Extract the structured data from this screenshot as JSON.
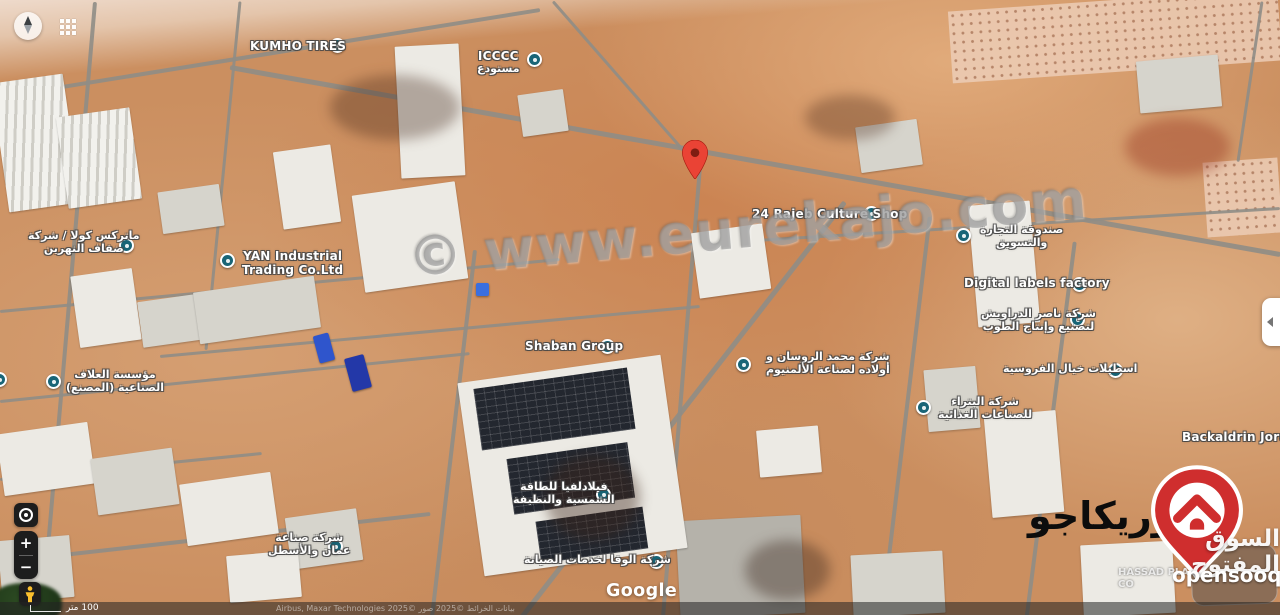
{
  "watermarks": {
    "center_url": "© www.eurekajo.com",
    "eurekajo_arabic": "يوريكاجو",
    "opensooq_arabic": "السوق المفتوح",
    "opensooq_latin": "opensooq"
  },
  "google_logo": "Google",
  "attribution": {
    "scale_label": "100 متر",
    "credits": "بيانات الخرائط ©2025 صور ©2025 Airbus, Maxar Technologies"
  },
  "controls": {
    "zoom_in": "+",
    "zoom_out": "−"
  },
  "hidden_label": {
    "line1": "HASSAD PLA",
    "line2": "CO"
  },
  "pin_color": "#ea4335",
  "marker_color": "#196577",
  "labels": [
    {
      "name": "kumho-tires",
      "lines": [
        "KUMHO TIRES"
      ],
      "x": 250,
      "y": 39,
      "mx": 330,
      "my": 38
    },
    {
      "name": "icccc-warehouse",
      "lines": [
        "ICCCC",
        "مستودع"
      ],
      "x": 477,
      "y": 49,
      "mx": 527,
      "my": 52
    },
    {
      "name": "rajeb-culture-shop",
      "lines": [
        "24 Rajeb Culture Shop"
      ],
      "x": 752,
      "y": 207,
      "mx": 864,
      "my": 206
    },
    {
      "name": "trade-marketing-fund",
      "lines": [
        "صندوقة التجارة",
        "والتسويق"
      ],
      "x": 980,
      "y": 224,
      "mx": 956,
      "my": 228
    },
    {
      "name": "digital-labels-factory",
      "lines": [
        "Digital labels factory"
      ],
      "x": 964,
      "y": 276,
      "mx": 1072,
      "my": 277
    },
    {
      "name": "nasser-darawish-bricks",
      "lines": [
        "شركة ناصر الدراويش",
        "لتصنيع وإنتاج الطوب"
      ],
      "x": 981,
      "y": 308,
      "mx": 1070,
      "my": 312
    },
    {
      "name": "equestrian-stables",
      "lines": [
        "اسطبلات خيال الفروسية"
      ],
      "x": 1003,
      "y": 363,
      "mx": 1108,
      "my": 363
    },
    {
      "name": "petra-food-industries",
      "lines": [
        "شركة البتراء",
        "للصناعات الغذائية"
      ],
      "x": 938,
      "y": 396,
      "mx": 916,
      "my": 400
    },
    {
      "name": "backaldrin-jordan",
      "lines": [
        "Backaldrin Jordan"
      ],
      "x": 1182,
      "y": 430
    },
    {
      "name": "matrix-cola",
      "lines": [
        "ماتركس كولا / شركة",
        "ضفاف النهرين"
      ],
      "x": 28,
      "y": 230,
      "mx": 119,
      "my": 238
    },
    {
      "name": "yan-industrial-trading",
      "lines": [
        "YAN Industrial",
        "Trading Co.Ltd"
      ],
      "x": 242,
      "y": 249,
      "mx": 220,
      "my": 253
    },
    {
      "name": "shaban-group",
      "lines": [
        "Shaban Group"
      ],
      "x": 525,
      "y": 339,
      "mx": 600,
      "my": 339
    },
    {
      "name": "roussan-aluminium",
      "lines": [
        "شركة محمد الروسان و",
        "أولاده لصناعة الألمنيوم"
      ],
      "x": 766,
      "y": 351,
      "mx": 736,
      "my": 357
    },
    {
      "name": "allaf-industrial",
      "lines": [
        "مؤسسة العلاف",
        "الصناعية (المصنع)"
      ],
      "x": 66,
      "y": 369,
      "mx": 46,
      "my": 374
    },
    {
      "name": "philadelphia-solar",
      "lines": [
        "فيلادلفيا للطاقة",
        "الشمسية والنظيفة"
      ],
      "x": 513,
      "y": 481,
      "mx": 596,
      "my": 487
    },
    {
      "name": "wafa-maintenance",
      "lines": [
        "شركة الوفا لخدمات الصيانة"
      ],
      "x": 524,
      "y": 554,
      "mx": 649,
      "my": 554
    },
    {
      "name": "sinaa-company",
      "lines": [
        "شركة صناعة",
        "عمان والأسطل"
      ],
      "x": 268,
      "y": 532,
      "mx": 328,
      "my": 539
    },
    {
      "name": "edge-place",
      "lines": [],
      "x": 0,
      "y": 0,
      "mx": -8,
      "my": 372
    }
  ]
}
